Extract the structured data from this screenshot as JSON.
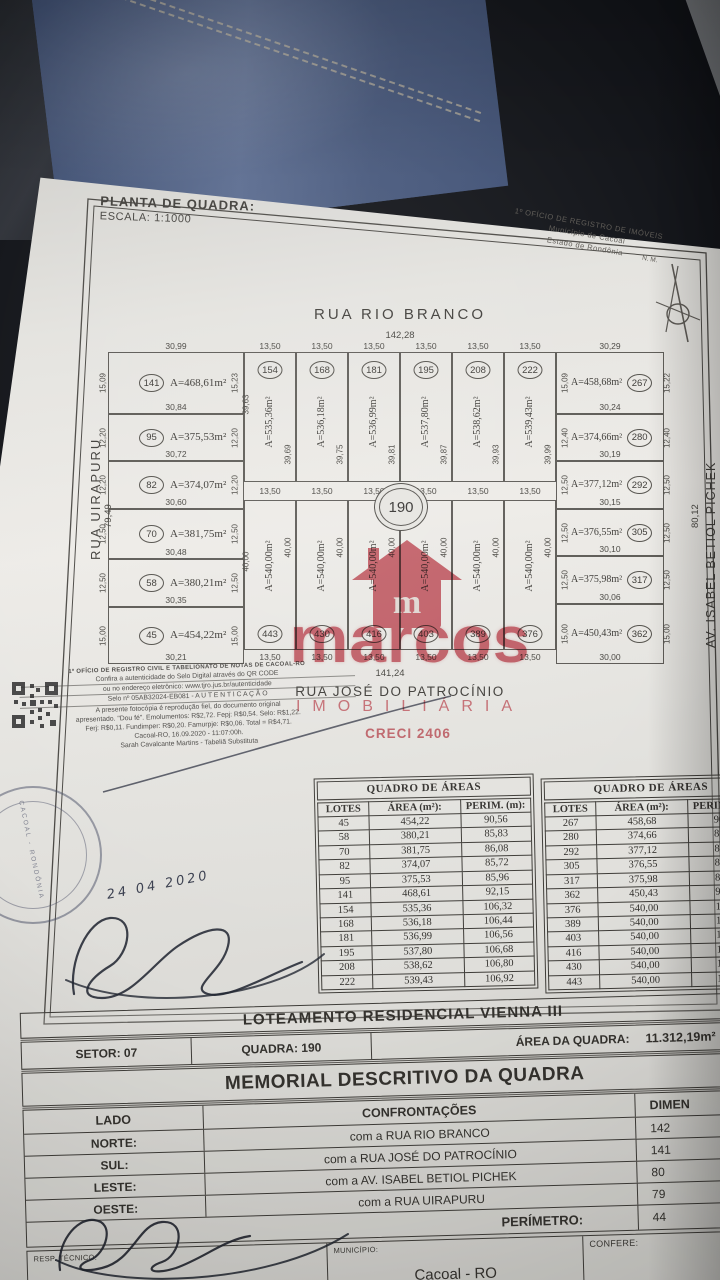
{
  "plan_header": {
    "title": "PLANTA DE QUADRA:",
    "scale": "ESCALA: 1:1000",
    "registry": {
      "line1": "1º OFÍCIO DE REGISTRO DE IMÓVEIS",
      "line2": "Município de Cacoal",
      "line3": "Estado de Rondônia",
      "north_mark": "N. M."
    }
  },
  "map": {
    "street_north": "RUA RIO BRANCO",
    "street_north_dim": "142,28",
    "street_south": "RUA JOSÉ DO PATROCÍNIO",
    "street_south_dim": "141,24",
    "street_west": "RUA UIRAPURU",
    "street_west_dim": "79,49",
    "street_east": "AV. ISABEL BETIOL PICHEK",
    "street_east_dim": "80,12",
    "quadra_circle": "190",
    "inner_dim_top_left": "39,63",
    "inner_dim_bottom_left": "40,00",
    "left_lots": [
      {
        "num": "141",
        "area": "A=468,61m²",
        "top": "30,99",
        "left": "15,09",
        "right": "15,23",
        "bottom": "30,84"
      },
      {
        "num": "95",
        "area": "A=375,53m²",
        "left": "12,20",
        "right": "12,20",
        "bottom": "30,72"
      },
      {
        "num": "82",
        "area": "A=374,07m²",
        "left": "12,20",
        "right": "12,20",
        "bottom": "30,60"
      },
      {
        "num": "70",
        "area": "A=381,75m²",
        "left": "12,50",
        "right": "12,50",
        "bottom": "30,48"
      },
      {
        "num": "58",
        "area": "A=380,21m²",
        "left": "12,50",
        "right": "12,50",
        "bottom": "30,35"
      },
      {
        "num": "45",
        "area": "A=454,22m²",
        "left": "15,00",
        "right": "15,00",
        "bottom": "30,21"
      }
    ],
    "right_lots": [
      {
        "num": "267",
        "area": "A=458,68m²",
        "top": "30,29",
        "left": "15,09",
        "right": "15,22",
        "bottom": "30,24"
      },
      {
        "num": "280",
        "area": "A=374,66m²",
        "left": "12,40",
        "right": "12,40",
        "bottom": "30,19"
      },
      {
        "num": "292",
        "area": "A=377,12m²",
        "left": "12,50",
        "right": "12,50",
        "bottom": "30,15"
      },
      {
        "num": "305",
        "area": "A=376,55m²",
        "left": "12,50",
        "right": "12,50",
        "bottom": "30,10"
      },
      {
        "num": "317",
        "area": "A=375,98m²",
        "left": "12,50",
        "right": "12,50",
        "bottom": "30,06"
      },
      {
        "num": "362",
        "area": "A=450,43m²",
        "left": "15,00",
        "right": "15,00",
        "bottom": "30,00"
      }
    ],
    "top_lots": [
      {
        "num": "154",
        "area": "A=535,36m²",
        "depth": "39,69",
        "w_top": "13,50",
        "w_bottom": "13,50"
      },
      {
        "num": "168",
        "area": "A=536,18m²",
        "depth": "39,75",
        "w_top": "13,50",
        "w_bottom": "13,50"
      },
      {
        "num": "181",
        "area": "A=536,99m²",
        "depth": "39,81",
        "w_top": "13,50",
        "w_bottom": "13,50"
      },
      {
        "num": "195",
        "area": "A=537,80m²",
        "depth": "39,87",
        "w_top": "13,50",
        "w_bottom": "13,50"
      },
      {
        "num": "208",
        "area": "A=538,62m²",
        "depth": "39,93",
        "w_top": "13,50",
        "w_bottom": "13,50"
      },
      {
        "num": "222",
        "area": "A=539,43m²",
        "depth": "39,99",
        "w_top": "13,50",
        "w_bottom": "13,50"
      }
    ],
    "bottom_lots": [
      {
        "num": "443",
        "area": "A=540,00m²",
        "depth": "40,00",
        "w": "13,50"
      },
      {
        "num": "430",
        "area": "A=540,00m²",
        "depth": "40,00",
        "w": "13,50"
      },
      {
        "num": "416",
        "area": "A=540,00m²",
        "depth": "40,00",
        "w": "13,50"
      },
      {
        "num": "403",
        "area": "A=540,00m²",
        "depth": "40,00",
        "w": "13,50"
      },
      {
        "num": "389",
        "area": "A=540,00m²",
        "depth": "40,00",
        "w": "13,50"
      },
      {
        "num": "376",
        "area": "A=540,00m²",
        "depth": "40,00",
        "w": "13,50"
      }
    ]
  },
  "watermark": {
    "logo_letter": "m",
    "name": "marcos",
    "tagline": "IMOBILIÁRIA",
    "creci": "CRECI 2406",
    "color": "#c7414e"
  },
  "auth": {
    "office": "1º OFÍCIO DE REGISTRO CIVIL E TABELIONATO DE NOTAS DE CACOAL-RO",
    "lines": [
      "Confira a autenticidade do Selo Digital através do QR CODE",
      "ou no endereço eletrônico: www.tjro.jus.br/autenticidade",
      "Selo nº 05AB32024-EB081 - A U T E N T I C A Ç Ã O",
      "A presente fotocópia é reprodução fiel, do documento original",
      "apresentado. \"Dou fé\". Emolumentos: R$2,72. Fepj: R$0,54. Selo: R$1,22.",
      "Ferj: R$0,11. Fundimper: R$0,20. Famurpje: R$0,06. Total = R$4,71.",
      "Cacoal-RO, 16.09.2020 - 11:07:00h.",
      "Sarah Cavalcante Martins - Tabeliã Substituta"
    ],
    "round_stamp_text": "CACOAL - RONDÔNIA",
    "hand_date": "24 04 2020"
  },
  "area_tables": {
    "left": {
      "title": "QUADRO DE ÁREAS",
      "headers": [
        "LOTES",
        "ÁREA (m²):",
        "PERIM. (m):"
      ],
      "rows": [
        [
          "45",
          "454,22",
          "90,56"
        ],
        [
          "58",
          "380,21",
          "85,83"
        ],
        [
          "70",
          "381,75",
          "86,08"
        ],
        [
          "82",
          "374,07",
          "85,72"
        ],
        [
          "95",
          "375,53",
          "85,96"
        ],
        [
          "141",
          "468,61",
          "92,15"
        ],
        [
          "154",
          "535,36",
          "106,32"
        ],
        [
          "168",
          "536,18",
          "106,44"
        ],
        [
          "181",
          "536,99",
          "106,56"
        ],
        [
          "195",
          "537,80",
          "106,68"
        ],
        [
          "208",
          "538,62",
          "106,80"
        ],
        [
          "222",
          "539,43",
          "106,92"
        ]
      ]
    },
    "right": {
      "title": "QUADRO DE ÁREAS",
      "headers": [
        "LOTES",
        "ÁREA (m²):",
        "PERIM. (m):"
      ],
      "rows": [
        [
          "267",
          "458,68",
          "90,5"
        ],
        [
          "280",
          "374,66",
          "85,8"
        ],
        [
          "292",
          "377,12",
          "85,9"
        ],
        [
          "305",
          "376,55",
          "85,7"
        ],
        [
          "317",
          "375,98",
          "85,9"
        ],
        [
          "362",
          "450,43",
          "90,4"
        ],
        [
          "376",
          "540,00",
          "107,"
        ],
        [
          "389",
          "540,00",
          "107,"
        ],
        [
          "403",
          "540,00",
          "107,"
        ],
        [
          "416",
          "540,00",
          "107,"
        ],
        [
          "430",
          "540,00",
          "107,"
        ],
        [
          "443",
          "540,00",
          "107,"
        ]
      ]
    }
  },
  "footer": {
    "loteamento": "LOTEAMENTO RESIDENCIAL VIENNA III",
    "setor": "SETOR: 07",
    "quadra": "QUADRA: 190",
    "area_quadra_label": "ÁREA DA QUADRA:",
    "area_quadra_value": "11.312,19m²",
    "memorial_title": "MEMORIAL DESCRITIVO DA QUADRA",
    "col_lado": "LADO",
    "col_confrontacoes": "CONFRONTAÇÕES",
    "col_dimen": "DIMEN",
    "rows": [
      {
        "lado": "NORTE:",
        "conf": "com a RUA RIO  BRANCO",
        "dim": "142"
      },
      {
        "lado": "SUL:",
        "conf": "com a RUA JOSÉ DO PATROCÍNIO",
        "dim": "141"
      },
      {
        "lado": "LESTE:",
        "conf": "com a AV. ISABEL BETIOL PICHEK",
        "dim": "80"
      },
      {
        "lado": "OESTE:",
        "conf": "com a RUA UIRAPURU",
        "dim": "79"
      }
    ],
    "perimetro_label": "PERÍMETRO:",
    "perimetro_value": "44",
    "resp_tecnico_label": "RESP. TÉCNICO:",
    "municipio_label": "MUNICÍPIO:",
    "municipio_value": "Cacoal - RO",
    "confere_label": "CONFERE:"
  }
}
